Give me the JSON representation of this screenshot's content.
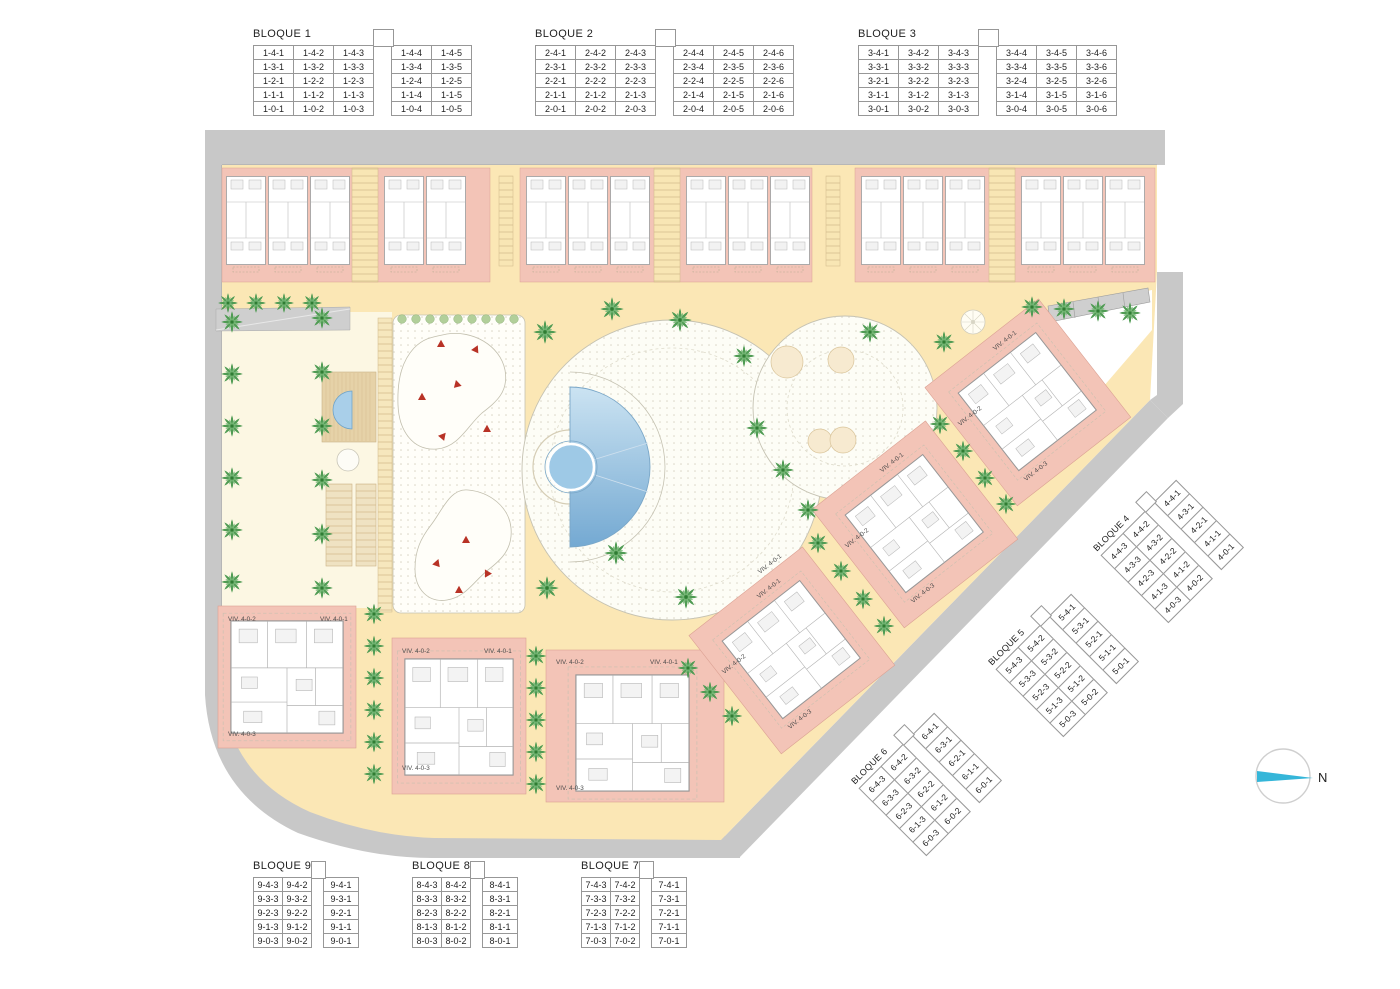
{
  "plan": {
    "north_label": "N",
    "viv_labels": {
      "v1": "VIV. 4-0-1",
      "v2": "VIV. 4-0-2",
      "v3": "VIV. 4-0-3"
    }
  },
  "colors": {
    "slab_pink": "#f3c4b7",
    "path_yellow": "#fbe7b5",
    "garden_cream": "#fcf7e3",
    "road_gray": "#c8c8c8",
    "pool_blue": "#8fbedd",
    "pool_blue_light": "#cbe3f2",
    "pool_blue_dark": "#74a9d2",
    "palm_green": "#4f9b53",
    "play_red": "#b83226",
    "north_cyan": "#35b6d9"
  },
  "blocks": [
    {
      "id": "b1",
      "title": "BLOQUE 1",
      "gap_before": 3,
      "rows": [
        [
          "1-4-1",
          "1-4-2",
          "1-4-3",
          "1-4-4",
          "1-4-5"
        ],
        [
          "1-3-1",
          "1-3-2",
          "1-3-3",
          "1-3-4",
          "1-3-5"
        ],
        [
          "1-2-1",
          "1-2-2",
          "1-2-3",
          "1-2-4",
          "1-2-5"
        ],
        [
          "1-1-1",
          "1-1-2",
          "1-1-3",
          "1-1-4",
          "1-1-5"
        ],
        [
          "1-0-1",
          "1-0-2",
          "1-0-3",
          "1-0-4",
          "1-0-5"
        ]
      ]
    },
    {
      "id": "b2",
      "title": "BLOQUE 2",
      "gap_before": 3,
      "rows": [
        [
          "2-4-1",
          "2-4-2",
          "2-4-3",
          "2-4-4",
          "2-4-5",
          "2-4-6"
        ],
        [
          "2-3-1",
          "2-3-2",
          "2-3-3",
          "2-3-4",
          "2-3-5",
          "2-3-6"
        ],
        [
          "2-2-1",
          "2-2-2",
          "2-2-3",
          "2-2-4",
          "2-2-5",
          "2-2-6"
        ],
        [
          "2-1-1",
          "2-1-2",
          "2-1-3",
          "2-1-4",
          "2-1-5",
          "2-1-6"
        ],
        [
          "2-0-1",
          "2-0-2",
          "2-0-3",
          "2-0-4",
          "2-0-5",
          "2-0-6"
        ]
      ]
    },
    {
      "id": "b3",
      "title": "BLOQUE 3",
      "gap_before": 3,
      "rows": [
        [
          "3-4-1",
          "3-4-2",
          "3-4-3",
          "3-4-4",
          "3-4-5",
          "3-4-6"
        ],
        [
          "3-3-1",
          "3-3-2",
          "3-3-3",
          "3-3-4",
          "3-3-5",
          "3-3-6"
        ],
        [
          "3-2-1",
          "3-2-2",
          "3-2-3",
          "3-2-4",
          "3-2-5",
          "3-2-6"
        ],
        [
          "3-1-1",
          "3-1-2",
          "3-1-3",
          "3-1-4",
          "3-1-5",
          "3-1-6"
        ],
        [
          "3-0-1",
          "3-0-2",
          "3-0-3",
          "3-0-4",
          "3-0-5",
          "3-0-6"
        ]
      ]
    },
    {
      "id": "b4",
      "title": "BLOQUE 4",
      "gap_before": 2,
      "rows": [
        [
          "4-4-3",
          "4-4-2",
          "4-4-1"
        ],
        [
          "4-3-3",
          "4-3-2",
          "4-3-1"
        ],
        [
          "4-2-3",
          "4-2-2",
          "4-2-1"
        ],
        [
          "4-1-3",
          "4-1-2",
          "4-1-1"
        ],
        [
          "4-0-3",
          "4-0-2",
          "4-0-1"
        ]
      ]
    },
    {
      "id": "b5",
      "title": "BLOQUE 5",
      "gap_before": 2,
      "rows": [
        [
          "5-4-3",
          "5-4-2",
          "5-4-1"
        ],
        [
          "5-3-3",
          "5-3-2",
          "5-3-1"
        ],
        [
          "5-2-3",
          "5-2-2",
          "5-2-1"
        ],
        [
          "5-1-3",
          "5-1-2",
          "5-1-1"
        ],
        [
          "5-0-3",
          "5-0-2",
          "5-0-1"
        ]
      ]
    },
    {
      "id": "b6",
      "title": "BLOQUE 6",
      "gap_before": 2,
      "rows": [
        [
          "6-4-3",
          "6-4-2",
          "6-4-1"
        ],
        [
          "6-3-3",
          "6-3-2",
          "6-3-1"
        ],
        [
          "6-2-3",
          "6-2-2",
          "6-2-1"
        ],
        [
          "6-1-3",
          "6-1-2",
          "6-1-1"
        ],
        [
          "6-0-3",
          "6-0-2",
          "6-0-1"
        ]
      ]
    },
    {
      "id": "b7",
      "title": "BLOQUE 7",
      "gap_before": 2,
      "rows": [
        [
          "7-4-3",
          "7-4-2",
          "7-4-1"
        ],
        [
          "7-3-3",
          "7-3-2",
          "7-3-1"
        ],
        [
          "7-2-3",
          "7-2-2",
          "7-2-1"
        ],
        [
          "7-1-3",
          "7-1-2",
          "7-1-1"
        ],
        [
          "7-0-3",
          "7-0-2",
          "7-0-1"
        ]
      ]
    },
    {
      "id": "b8",
      "title": "BLOQUE 8",
      "gap_before": 2,
      "rows": [
        [
          "8-4-3",
          "8-4-2",
          "8-4-1"
        ],
        [
          "8-3-3",
          "8-3-2",
          "8-3-1"
        ],
        [
          "8-2-3",
          "8-2-2",
          "8-2-1"
        ],
        [
          "8-1-3",
          "8-1-2",
          "8-1-1"
        ],
        [
          "8-0-3",
          "8-0-2",
          "8-0-1"
        ]
      ]
    },
    {
      "id": "b9",
      "title": "BLOQUE 9",
      "gap_before": 2,
      "rows": [
        [
          "9-4-3",
          "9-4-2",
          "9-4-1"
        ],
        [
          "9-3-3",
          "9-3-2",
          "9-3-1"
        ],
        [
          "9-2-3",
          "9-2-2",
          "9-2-1"
        ],
        [
          "9-1-3",
          "9-1-2",
          "9-1-1"
        ],
        [
          "9-0-3",
          "9-0-2",
          "9-0-1"
        ]
      ]
    }
  ]
}
